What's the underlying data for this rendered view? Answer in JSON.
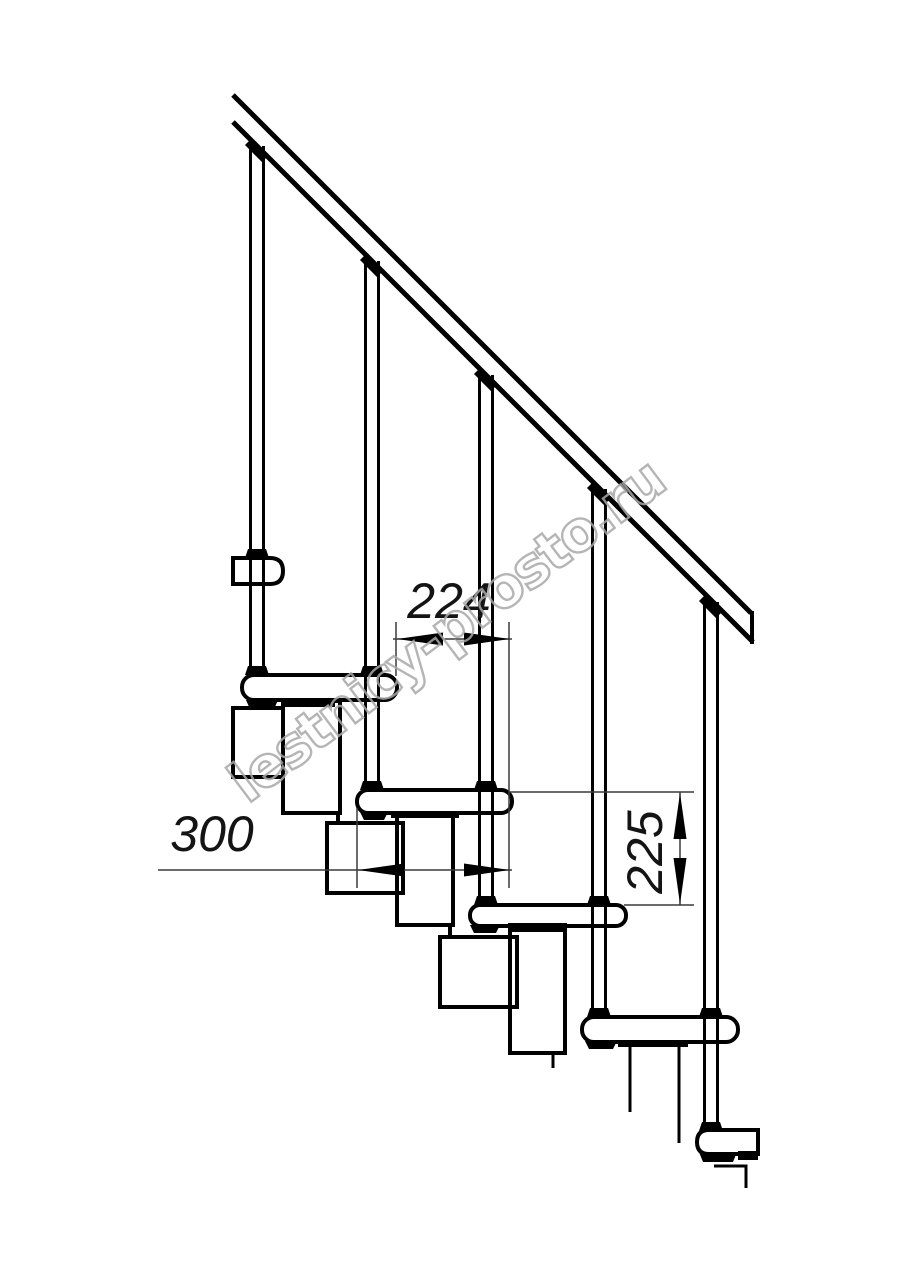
{
  "drawing": {
    "subject": "modular staircase side elevation drawing",
    "dims": {
      "run": "224",
      "depth": "300",
      "rise": "225"
    },
    "watermark": {
      "text": "lestnicy-prosto.ru",
      "color": "#a9a9a9"
    },
    "colors": {
      "line": "#000000",
      "dim_line": "#3a3a3a",
      "background": "#ffffff"
    }
  }
}
